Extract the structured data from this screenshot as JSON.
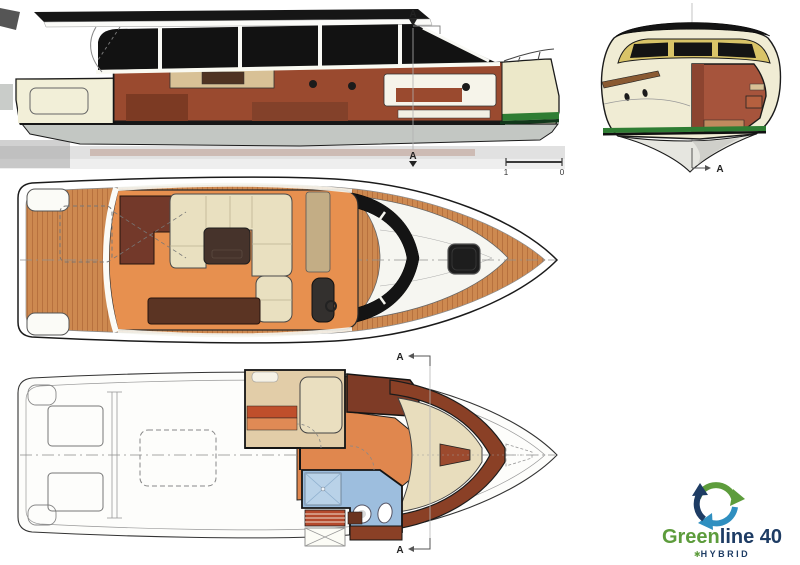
{
  "drawing": {
    "section_label": "A",
    "scale_bar": {
      "left": "1",
      "right": "0"
    }
  },
  "logo": {
    "brand_green": "Green",
    "brand_navy": "line 40",
    "star": "✱",
    "tagline": "HYBRID"
  },
  "colors": {
    "hull_cream": "#ece8c9",
    "teak_deck": "#cd8950",
    "teak_seam": "#a25a2c",
    "interior_wood": "#9a4a2f",
    "dark_wood": "#73392a",
    "salon_floor_orange": "#e7904f",
    "upholstery_cream": "#e9e0c0",
    "table_brown": "#46332b",
    "glazing_black": "#141414",
    "waterline_green": "#2f7d33",
    "windshield_frame_gold": "#d9c468",
    "bathroom_blue": "#9dbede",
    "logo_green": "#5d9c3c",
    "logo_navy": "#1e3c64",
    "logo_blue": "#2f8fc0"
  }
}
